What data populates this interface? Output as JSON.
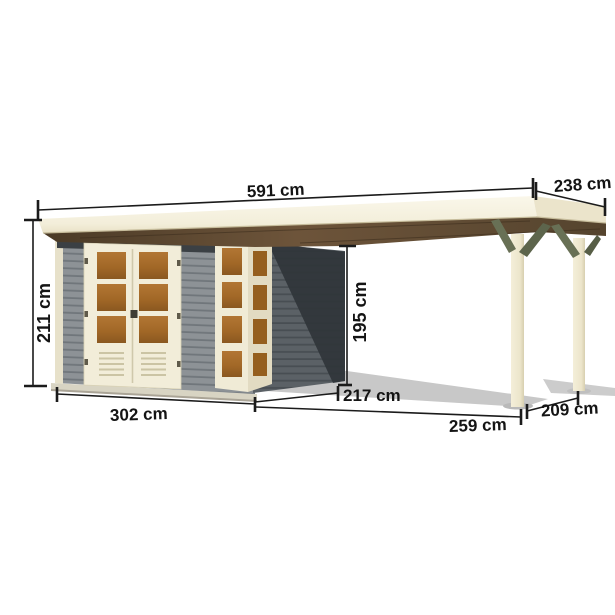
{
  "diagram": {
    "unit": "cm",
    "dimensions": {
      "roof_total_width": "591 cm",
      "roof_depth": "238 cm",
      "left_wall_height": "211 cm",
      "canopy_clear_height": "195 cm",
      "shed_front_width": "302 cm",
      "shed_side_depth": "217 cm",
      "canopy_front_width": "259 cm",
      "canopy_side_depth": "209 cm"
    },
    "colors": {
      "background": "#ffffff",
      "roof_cream": "#f5f1e1",
      "roof_underside_brown": "#5e4a32",
      "wall_gray": "#8d9296",
      "side_wall_shadow": "#34383c",
      "frame_cream": "#f2edd9",
      "window_brown": "#a86f2e",
      "brace_olive": "#687055",
      "post_cream": "#f0ead4",
      "dimension_line": "#1b1b1b",
      "ground_shadow": "#c8c8c8"
    }
  }
}
